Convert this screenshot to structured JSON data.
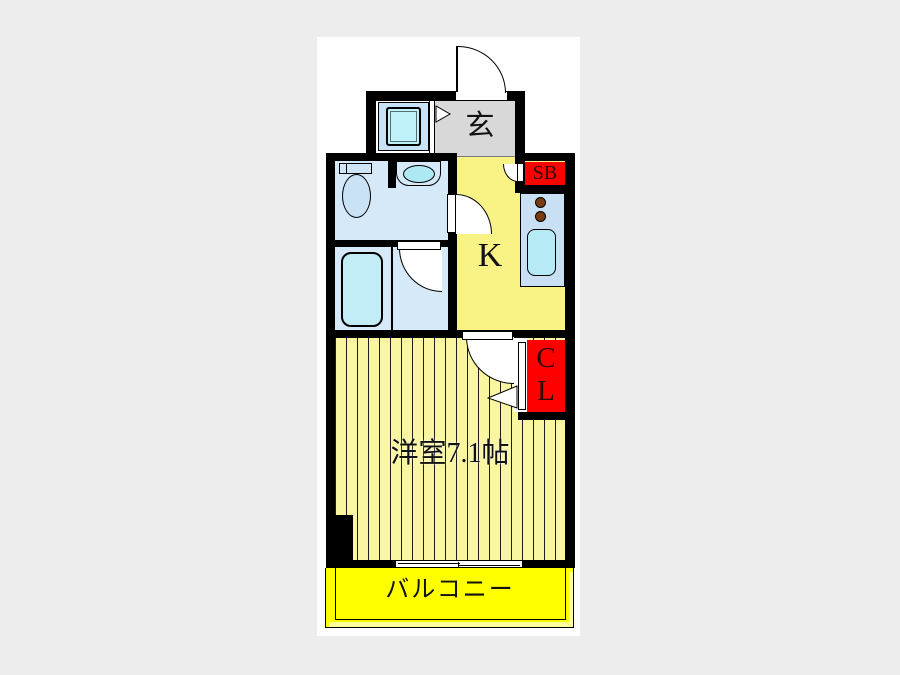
{
  "floor_plan": {
    "type": "apartment-floor-plan",
    "rooms": {
      "entrance": {
        "label": "玄"
      },
      "kitchen": {
        "label": "K"
      },
      "shoe_box": {
        "label": "SB"
      },
      "closet": {
        "label_line1": "C",
        "label_line2": "L"
      },
      "main_room": {
        "label": "洋室7.1帖"
      },
      "balcony": {
        "label": "バルコニー"
      }
    },
    "colors": {
      "page_background": "#EDEDED",
      "plan_background": "#FFFFFF",
      "wall": "#000000",
      "entrance_floor": "#D8D8D8",
      "kitchen_floor": "#F9F285",
      "main_room_floor": "#FAF5A1",
      "balcony_floor": "#FFFF00",
      "balcony_edge": "#FFFF9C",
      "wet_area_floor": "#D6E9F9",
      "counter": "#C9E0F4",
      "fixture_cyan": "#B9ECF5",
      "accent_red": "#FF0000",
      "burner_brown": "#7A3B10",
      "label_color": "#111111",
      "red_block_label_color": "#2E0A05"
    }
  }
}
